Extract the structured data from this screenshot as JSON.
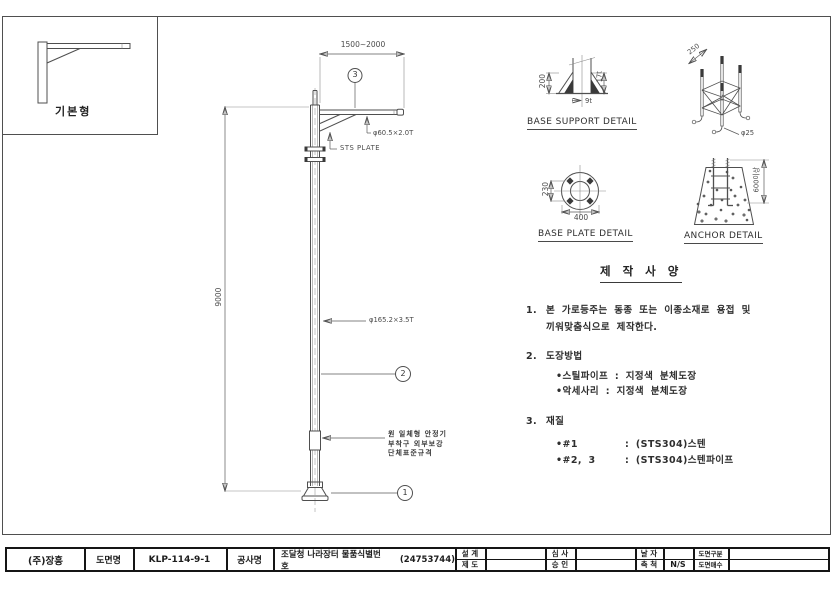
{
  "basic_box": {
    "label": "기본형"
  },
  "pole": {
    "dim_arm": "1500~2000",
    "dim_height": "9000",
    "balloon_top": "3",
    "balloon_mid": "2",
    "balloon_base": "1",
    "plate_label": "STS PLATE",
    "arm_spec": "φ60.5×2.0T",
    "pole_spec": "φ165.2×3.5T",
    "note_line1": "원 일체형 안정기",
    "note_line2": "부착구 외부보강",
    "note_line3": "단체표준규격"
  },
  "base_support": {
    "title": "BASE SUPPORT DETAIL",
    "dim_height": "200",
    "dim_plate": "17t",
    "dim_rib": "9t"
  },
  "anchor_cage": {
    "dim_width": "250",
    "dim_bolt": "φ25"
  },
  "base_plate": {
    "title": "BASE PLATE DETAIL",
    "dim_pitch": "230",
    "dim_outer": "400"
  },
  "anchor": {
    "title": "ANCHOR DETAIL",
    "dim_depth": "600이상"
  },
  "specs": {
    "title": "제 작 사 양",
    "item1_no": "1.",
    "item1_line1": "본 가로등주는 동종 또는 이종소재로 용접 및",
    "item1_line2": "끼워맞춤식으로 제작한다.",
    "item2_no": "2.",
    "item2_title": "도장방법",
    "item2_b1": "•스틸파이프 : 지정색 분체도장",
    "item2_b2": "•악세사리 : 지정색 분체도장",
    "item3_no": "3.",
    "item3_title": "재질",
    "item3_b1_label": "•#1",
    "item3_b1_value": ": (STS304)스텐",
    "item3_b2_label": "•#2, 3",
    "item3_b2_value": ": (STS304)스텐파이프"
  },
  "titleblock": {
    "company": "(주)장흥",
    "name_label": "도면명",
    "dwg_no": "KLP-114-9-1",
    "project_label": "공사명",
    "project_text": "조달청 나라장터 물품식별번호",
    "project_id": "(24753744)",
    "design": "설 계",
    "draft": "제 도",
    "review": "심 사",
    "approve": "승 인",
    "date": "날 자",
    "scale": "축 척",
    "scale_value": "N/S",
    "class": "도면구분",
    "sheets": "도면매수"
  }
}
